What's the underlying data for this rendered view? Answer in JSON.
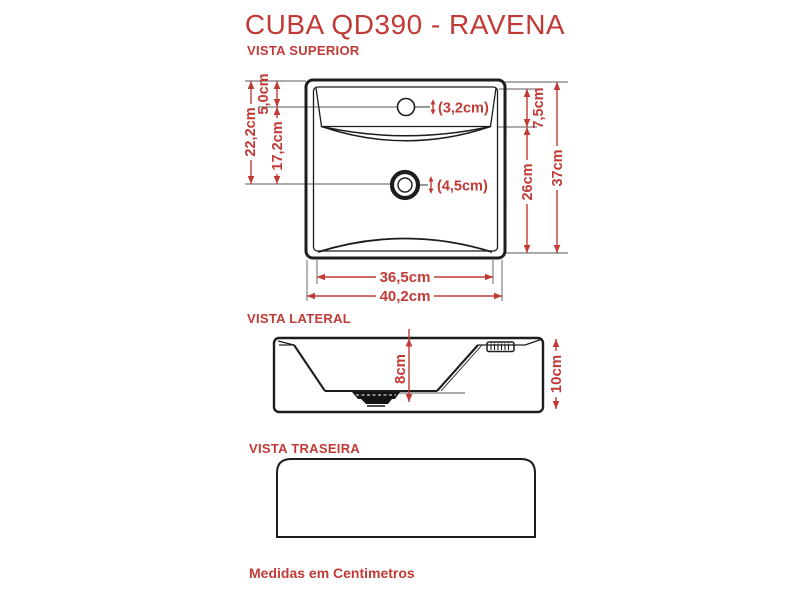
{
  "page": {
    "title": "CUBA QD390 - RAVENA",
    "note": "Medidas em Centimetros",
    "colors": {
      "accent": "#c13a36",
      "line": "#1d1d1d",
      "background": "#ffffff"
    }
  },
  "views": {
    "superior": {
      "label": "VISTA SUPERIOR",
      "dimensions": {
        "left_total": "22,2cm",
        "left_upper": "5,0cm",
        "left_lower": "17,2cm",
        "faucet_hole_diameter": "(3,2cm)",
        "drain_hole_diameter": "(4,5cm)",
        "right_upper": "7,5cm",
        "right_lower": "26cm",
        "right_total": "37cm",
        "bottom_inner_width": "36,5cm",
        "bottom_outer_width": "40,2cm"
      }
    },
    "lateral": {
      "label": "VISTA LATERAL",
      "dimensions": {
        "basin_depth": "8cm",
        "total_height": "10cm"
      }
    },
    "traseira": {
      "label": "VISTA TRASEIRA"
    }
  }
}
